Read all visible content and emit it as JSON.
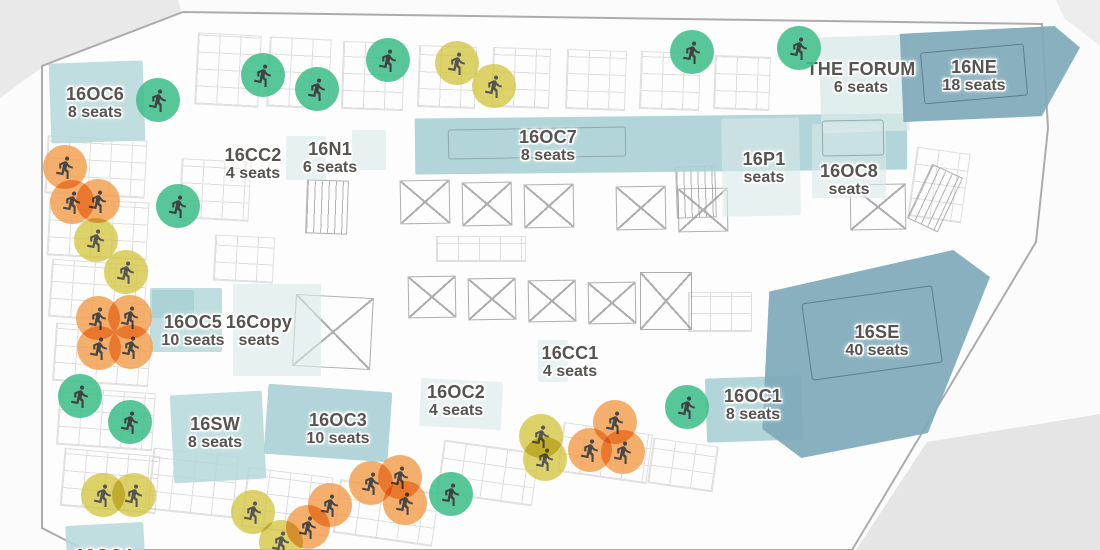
{
  "floorplan": {
    "rooms": {
      "oc6": {
        "name": "16OC6",
        "seats": "8 seats"
      },
      "cc2": {
        "name": "16CC2",
        "seats": "4 seats"
      },
      "n1": {
        "name": "16N1",
        "seats": "6 seats"
      },
      "oc7": {
        "name": "16OC7",
        "seats": "8 seats"
      },
      "p1": {
        "name": "16P1",
        "seats": "seats"
      },
      "oc8": {
        "name": "16OC8",
        "seats": "seats"
      },
      "forum": {
        "name": "THE FORUM",
        "seats": "6 seats"
      },
      "ne": {
        "name": "16NE",
        "seats": "18 seats"
      },
      "oc5": {
        "name": "16OC5",
        "seats": "10 seats"
      },
      "copy": {
        "name": "16Copy",
        "seats": "seats"
      },
      "cc1": {
        "name": "16CC1",
        "seats": "4 seats"
      },
      "oc2": {
        "name": "16OC2",
        "seats": "4 seats"
      },
      "sw": {
        "name": "16SW",
        "seats": "8 seats"
      },
      "oc3": {
        "name": "16OC3",
        "seats": "10 seats"
      },
      "oc1": {
        "name": "16OC1",
        "seats": "8 seats"
      },
      "se": {
        "name": "16SE",
        "seats": "40 seats"
      },
      "oc4": {
        "name": "16OC4",
        "seats": ""
      }
    },
    "occupancy_markers": [
      {
        "color": "green",
        "x": 158,
        "y": 100
      },
      {
        "color": "green",
        "x": 263,
        "y": 75
      },
      {
        "color": "green",
        "x": 317,
        "y": 89
      },
      {
        "color": "green",
        "x": 388,
        "y": 60
      },
      {
        "color": "green",
        "x": 692,
        "y": 52
      },
      {
        "color": "green",
        "x": 799,
        "y": 48
      },
      {
        "color": "green",
        "x": 178,
        "y": 206
      },
      {
        "color": "green",
        "x": 80,
        "y": 396
      },
      {
        "color": "green",
        "x": 130,
        "y": 422
      },
      {
        "color": "green",
        "x": 451,
        "y": 494
      },
      {
        "color": "green",
        "x": 687,
        "y": 407
      },
      {
        "color": "yellow",
        "x": 457,
        "y": 63
      },
      {
        "color": "yellow",
        "x": 494,
        "y": 86
      },
      {
        "color": "yellow",
        "x": 96,
        "y": 240
      },
      {
        "color": "yellow",
        "x": 126,
        "y": 272
      },
      {
        "color": "yellow",
        "x": 103,
        "y": 495
      },
      {
        "color": "yellow",
        "x": 134,
        "y": 495
      },
      {
        "color": "yellow",
        "x": 253,
        "y": 512
      },
      {
        "color": "yellow",
        "x": 281,
        "y": 542
      },
      {
        "color": "yellow",
        "x": 541,
        "y": 436
      },
      {
        "color": "yellow",
        "x": 545,
        "y": 459
      },
      {
        "color": "orange",
        "x": 65,
        "y": 167
      },
      {
        "color": "orange",
        "x": 72,
        "y": 202
      },
      {
        "color": "orange",
        "x": 98,
        "y": 201
      },
      {
        "color": "orange",
        "x": 98,
        "y": 318
      },
      {
        "color": "orange",
        "x": 130,
        "y": 317
      },
      {
        "color": "orange",
        "x": 99,
        "y": 348
      },
      {
        "color": "orange",
        "x": 131,
        "y": 347
      },
      {
        "color": "orange",
        "x": 308,
        "y": 527
      },
      {
        "color": "orange",
        "x": 330,
        "y": 505
      },
      {
        "color": "orange",
        "x": 371,
        "y": 483
      },
      {
        "color": "orange",
        "x": 400,
        "y": 477
      },
      {
        "color": "orange",
        "x": 405,
        "y": 503
      },
      {
        "color": "orange",
        "x": 590,
        "y": 450
      },
      {
        "color": "orange",
        "x": 615,
        "y": 422
      },
      {
        "color": "orange",
        "x": 623,
        "y": 452
      }
    ],
    "icons": {
      "marker": "person-running-icon"
    },
    "colors": {
      "marker-green": "#3fbe8a",
      "marker-yellow": "#d4c43e",
      "marker-orange": "#f2a152",
      "room-light": "#b5d7d9",
      "room-medium": "#a8d0d4",
      "room-pale": "#d8eae9",
      "room-dark": "#7fa9ba",
      "label-text": "#565350",
      "wall": "#9a9a9a",
      "furniture": "#c6c6c6",
      "street": "#e5e5e5",
      "person-icon": "#272727"
    }
  }
}
